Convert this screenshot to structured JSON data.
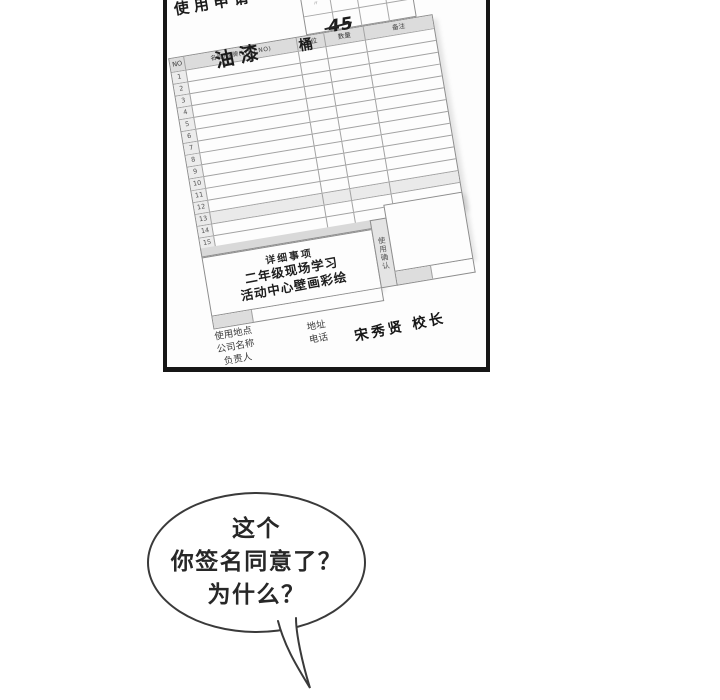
{
  "colors": {
    "panel_border": "#161616",
    "paper": "#fdfdfd",
    "table_line": "#a2a2a2",
    "header_shade": "#dcdcdc",
    "band_shade": "#d9d9d9",
    "ink": "#272727"
  },
  "form": {
    "title": "使用申请",
    "table": {
      "headers": {
        "no": "NO",
        "name": "名称/品牌(LD.T.NO)",
        "unit": "单位",
        "qty": "数量",
        "note": "备注"
      },
      "row_numbers": [
        "1",
        "2",
        "3",
        "4",
        "5",
        "6",
        "7",
        "8",
        "9",
        "10",
        "11",
        "12",
        "13",
        "14",
        "15"
      ],
      "entry": {
        "name": "油漆",
        "unit": "桶",
        "qty": "45"
      }
    },
    "details": {
      "label": "详细事项",
      "line1": "二年级现场学习",
      "line2": "活动中心壁画彩绘",
      "confirm": "使用确认"
    },
    "footer": {
      "labels_left": [
        "使用地点",
        "公司名称",
        "负责人"
      ],
      "labels_mid": [
        "地址",
        "电话"
      ],
      "signature": "宋秀贤  校长"
    }
  },
  "bubble": {
    "lines": [
      "这个",
      "你签名同意了？",
      "为什么？"
    ]
  }
}
